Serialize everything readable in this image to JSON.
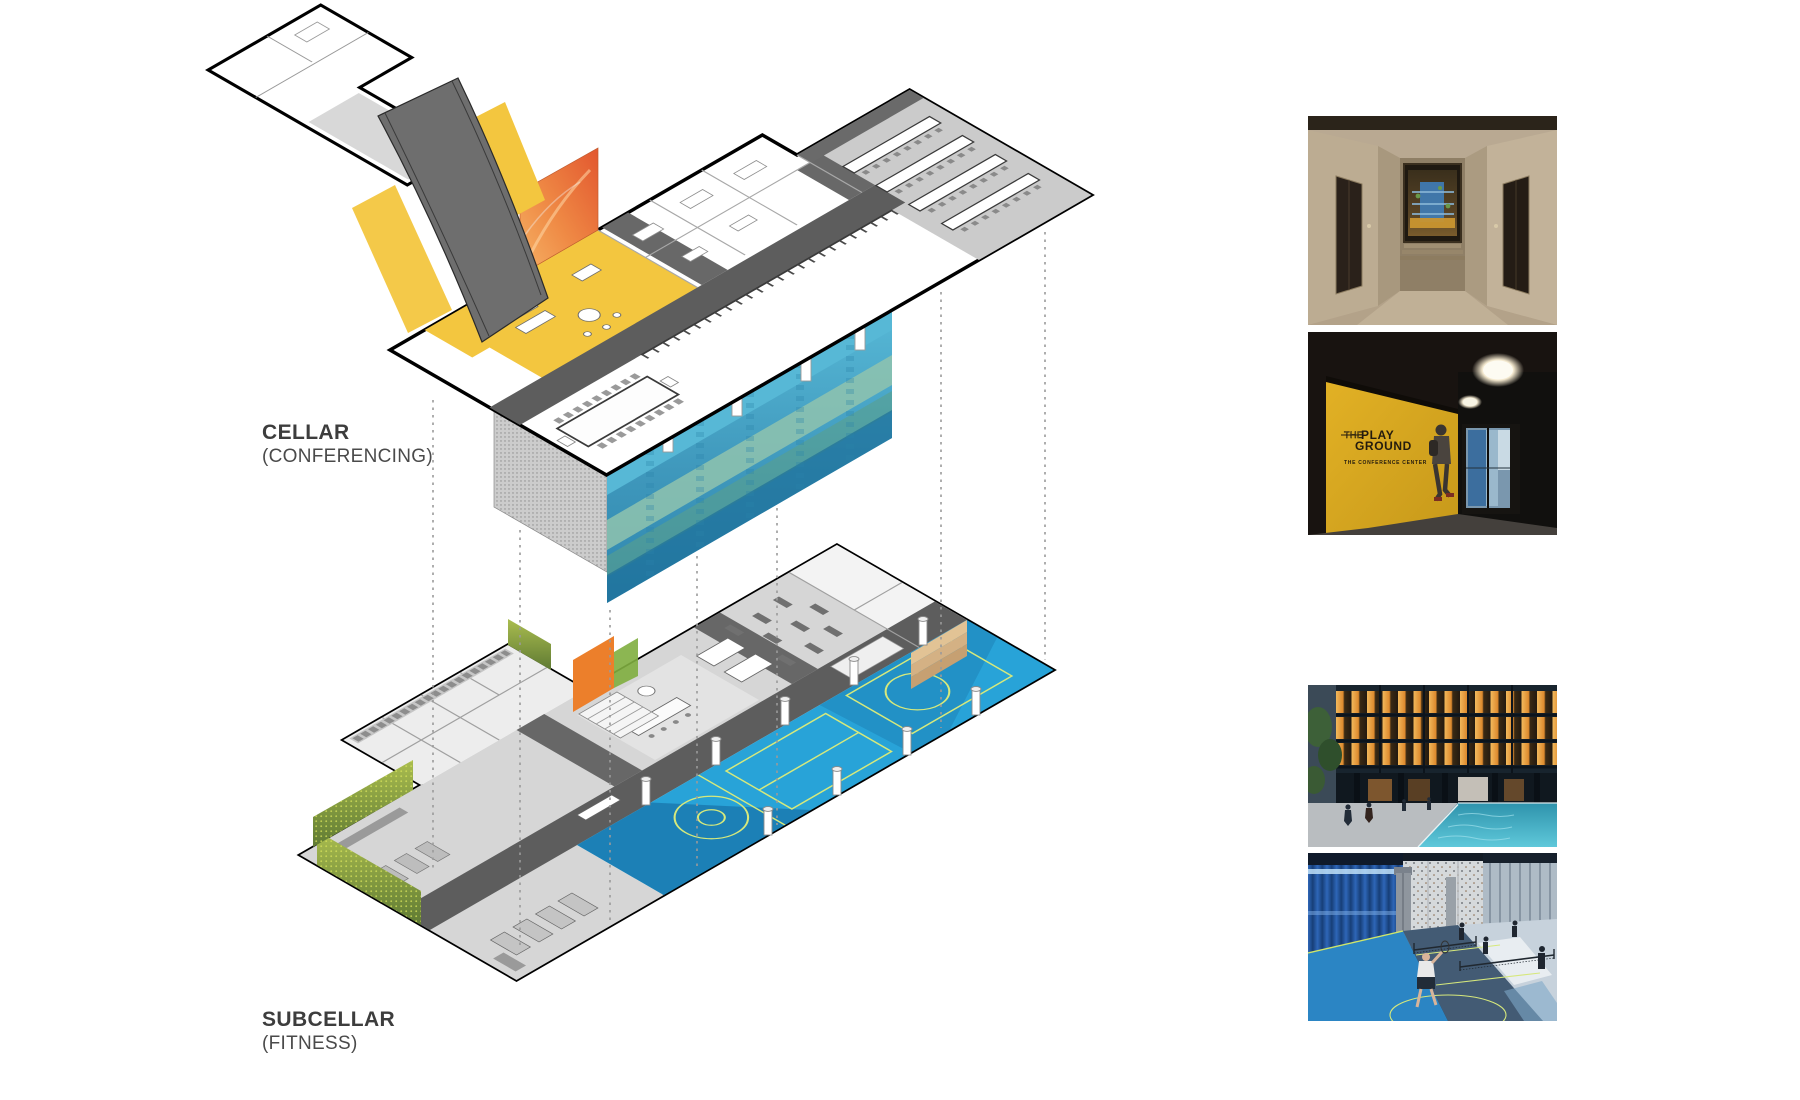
{
  "diagram": {
    "type": "exploded-axonometric-floor-plans",
    "levels": [
      {
        "label": "CELLAR",
        "sublabel": "(CONFERENCING)"
      },
      {
        "label": "SUBCELLAR",
        "sublabel": "(FITNESS)"
      }
    ],
    "colors": {
      "lounge_yellow": "#f3c63f",
      "corridor_gray": "#5d5d5d",
      "court_blue": "#28a3d8",
      "court_blue_dark": "#1b7cb2",
      "court_line_lime": "#d6e97c",
      "mural_teal": "#57b8d6",
      "mural_green": "#8fc3ae",
      "wood_tan": "#dcbb8d",
      "accent_orange": "#ec7f2b",
      "plant_green": "#8fae3f",
      "outline_black": "#000000"
    }
  },
  "photos": {
    "conference_entrance": {
      "logo_the": "THE",
      "logo_play": "PLAY",
      "logo_ground": "GROUND",
      "tagline": "THE CONFERENCE CENTER"
    }
  }
}
